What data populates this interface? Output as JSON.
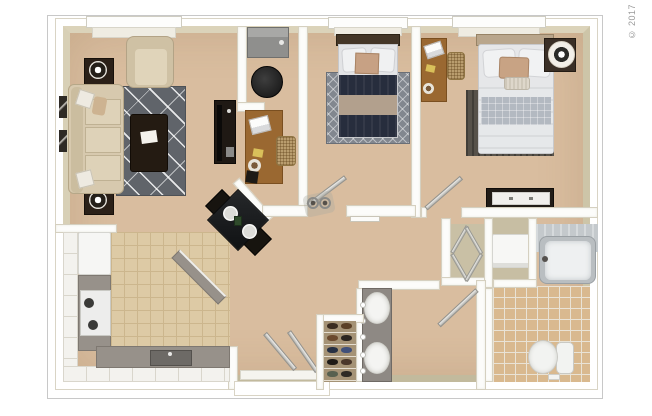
{
  "copyright": "© 2017",
  "rooms": [
    "living-room",
    "den",
    "bedroom",
    "master-bedroom",
    "kitchen",
    "dining-area",
    "hallway",
    "bathroom",
    "master-bathroom",
    "linen-closet",
    "shoe-closet",
    "laundry-closet",
    "entry"
  ],
  "palette": {
    "page_bg": "#ffffff",
    "frame_border": "#c8c8c8",
    "carpet": "#d9bd9f",
    "kitchen_tile": "#ddcaa5",
    "kitchen_grout": "#ccb68d",
    "bath_tile": "#d9b98f",
    "bath_grout": "#e9e3d6",
    "rug_living": "#60646a",
    "rug_bedroom": "#82878f",
    "navy_bed": "#272d3d",
    "sofa": "#d7c9ae",
    "wood": "#9a6831",
    "dark_furniture": "#26201a",
    "counter": "#97918a",
    "white_fixture": "#f4f4f1",
    "copyright_color": "#9a9a9a"
  }
}
